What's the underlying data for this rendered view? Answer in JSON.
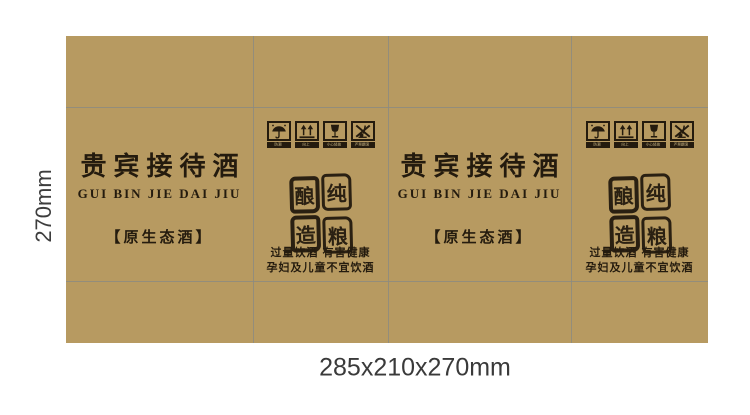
{
  "colors": {
    "board": "#b79a61",
    "ink": "#241b0e",
    "fold_line": "#8d8b80",
    "background": "#ffffff",
    "dimension_text": "#3d3d3d"
  },
  "dimensions": {
    "side_label": "270mm",
    "bottom_label": "285x210x270mm"
  },
  "front_panel": {
    "title": "贵宾接待酒",
    "subtitle": "GUI BIN JIE DAI JIU",
    "tagline": "【原生态酒】"
  },
  "side_panel": {
    "icons": [
      {
        "name": "keep-dry-icon",
        "label": "防潮"
      },
      {
        "name": "this-way-up-icon",
        "label": "向上"
      },
      {
        "name": "fragile-icon",
        "label": "小心轻放"
      },
      {
        "name": "no-rolling-icon",
        "label": "严禁翻滚"
      }
    ],
    "seal": {
      "reading": "纯粮酿造",
      "chars": [
        "酿",
        "纯",
        "造",
        "粮"
      ]
    },
    "warning_line1": "过量饮酒 有害健康",
    "warning_line2": "孕妇及儿童不宜饮酒"
  }
}
